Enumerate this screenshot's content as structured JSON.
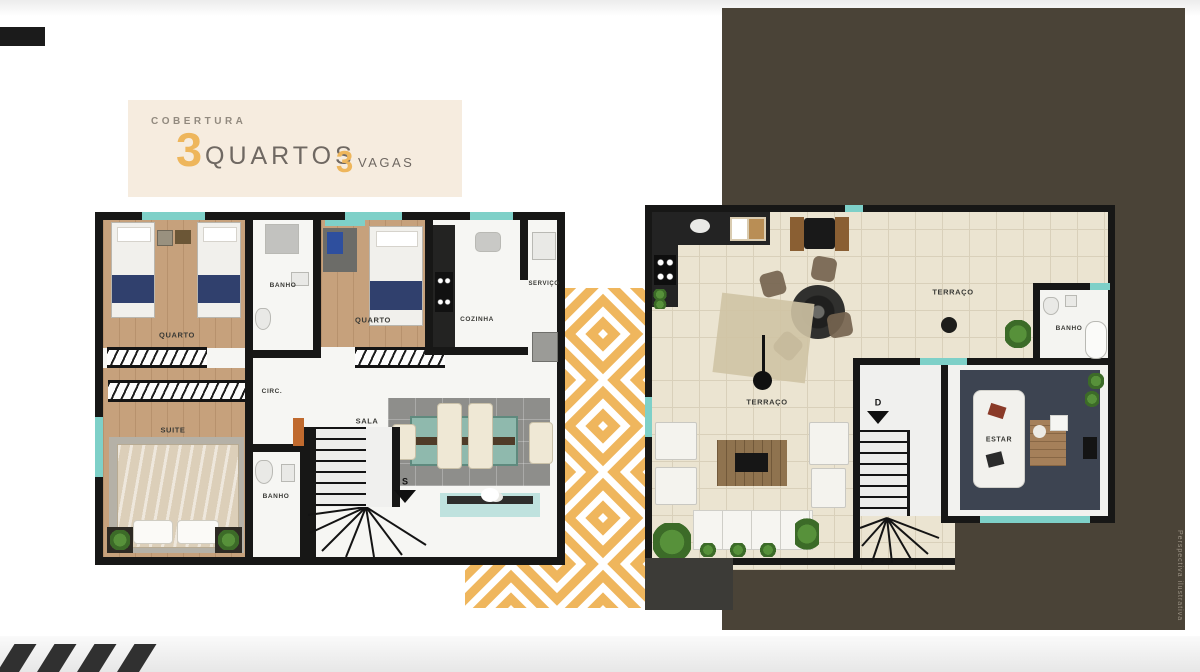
{
  "title_block": {
    "kicker": "COBERTURA",
    "stat1": {
      "value": "3",
      "label": "QUARTOS"
    },
    "stat2": {
      "value": "3",
      "label": "VAGAS"
    }
  },
  "plan_upper": {
    "name": "lower-floor-plan",
    "rooms": {
      "quarto1": "QUARTO",
      "banho1": "BANHO",
      "quarto2": "QUARTO",
      "cozinha": "COZINHA",
      "servico": "SERVIÇO",
      "circ": "CIRC.",
      "sala": "SALA",
      "suite": "SUITE",
      "banho2": "BANHO"
    },
    "stair_marker": "S"
  },
  "plan_roof": {
    "name": "roof-terrace-plan",
    "rooms": {
      "terraco_right": "TERRAÇO",
      "terraco_center": "TERRAÇO",
      "banho": "BANHO",
      "estar": "ESTAR"
    },
    "stair_marker": "D"
  },
  "watermark": {
    "text": "Perspectiva ilustrativa"
  },
  "colors": {
    "accent_gold": "#EEB65C",
    "backdrop_brown": "#4A4337",
    "cream_panel": "#F6ECDF",
    "teal_accent": "#7ED0C8",
    "wood_floor": "#C6A17C",
    "navy_blanket": "#30406D",
    "wall_black": "#171716",
    "title_gray": "#6F6862"
  }
}
